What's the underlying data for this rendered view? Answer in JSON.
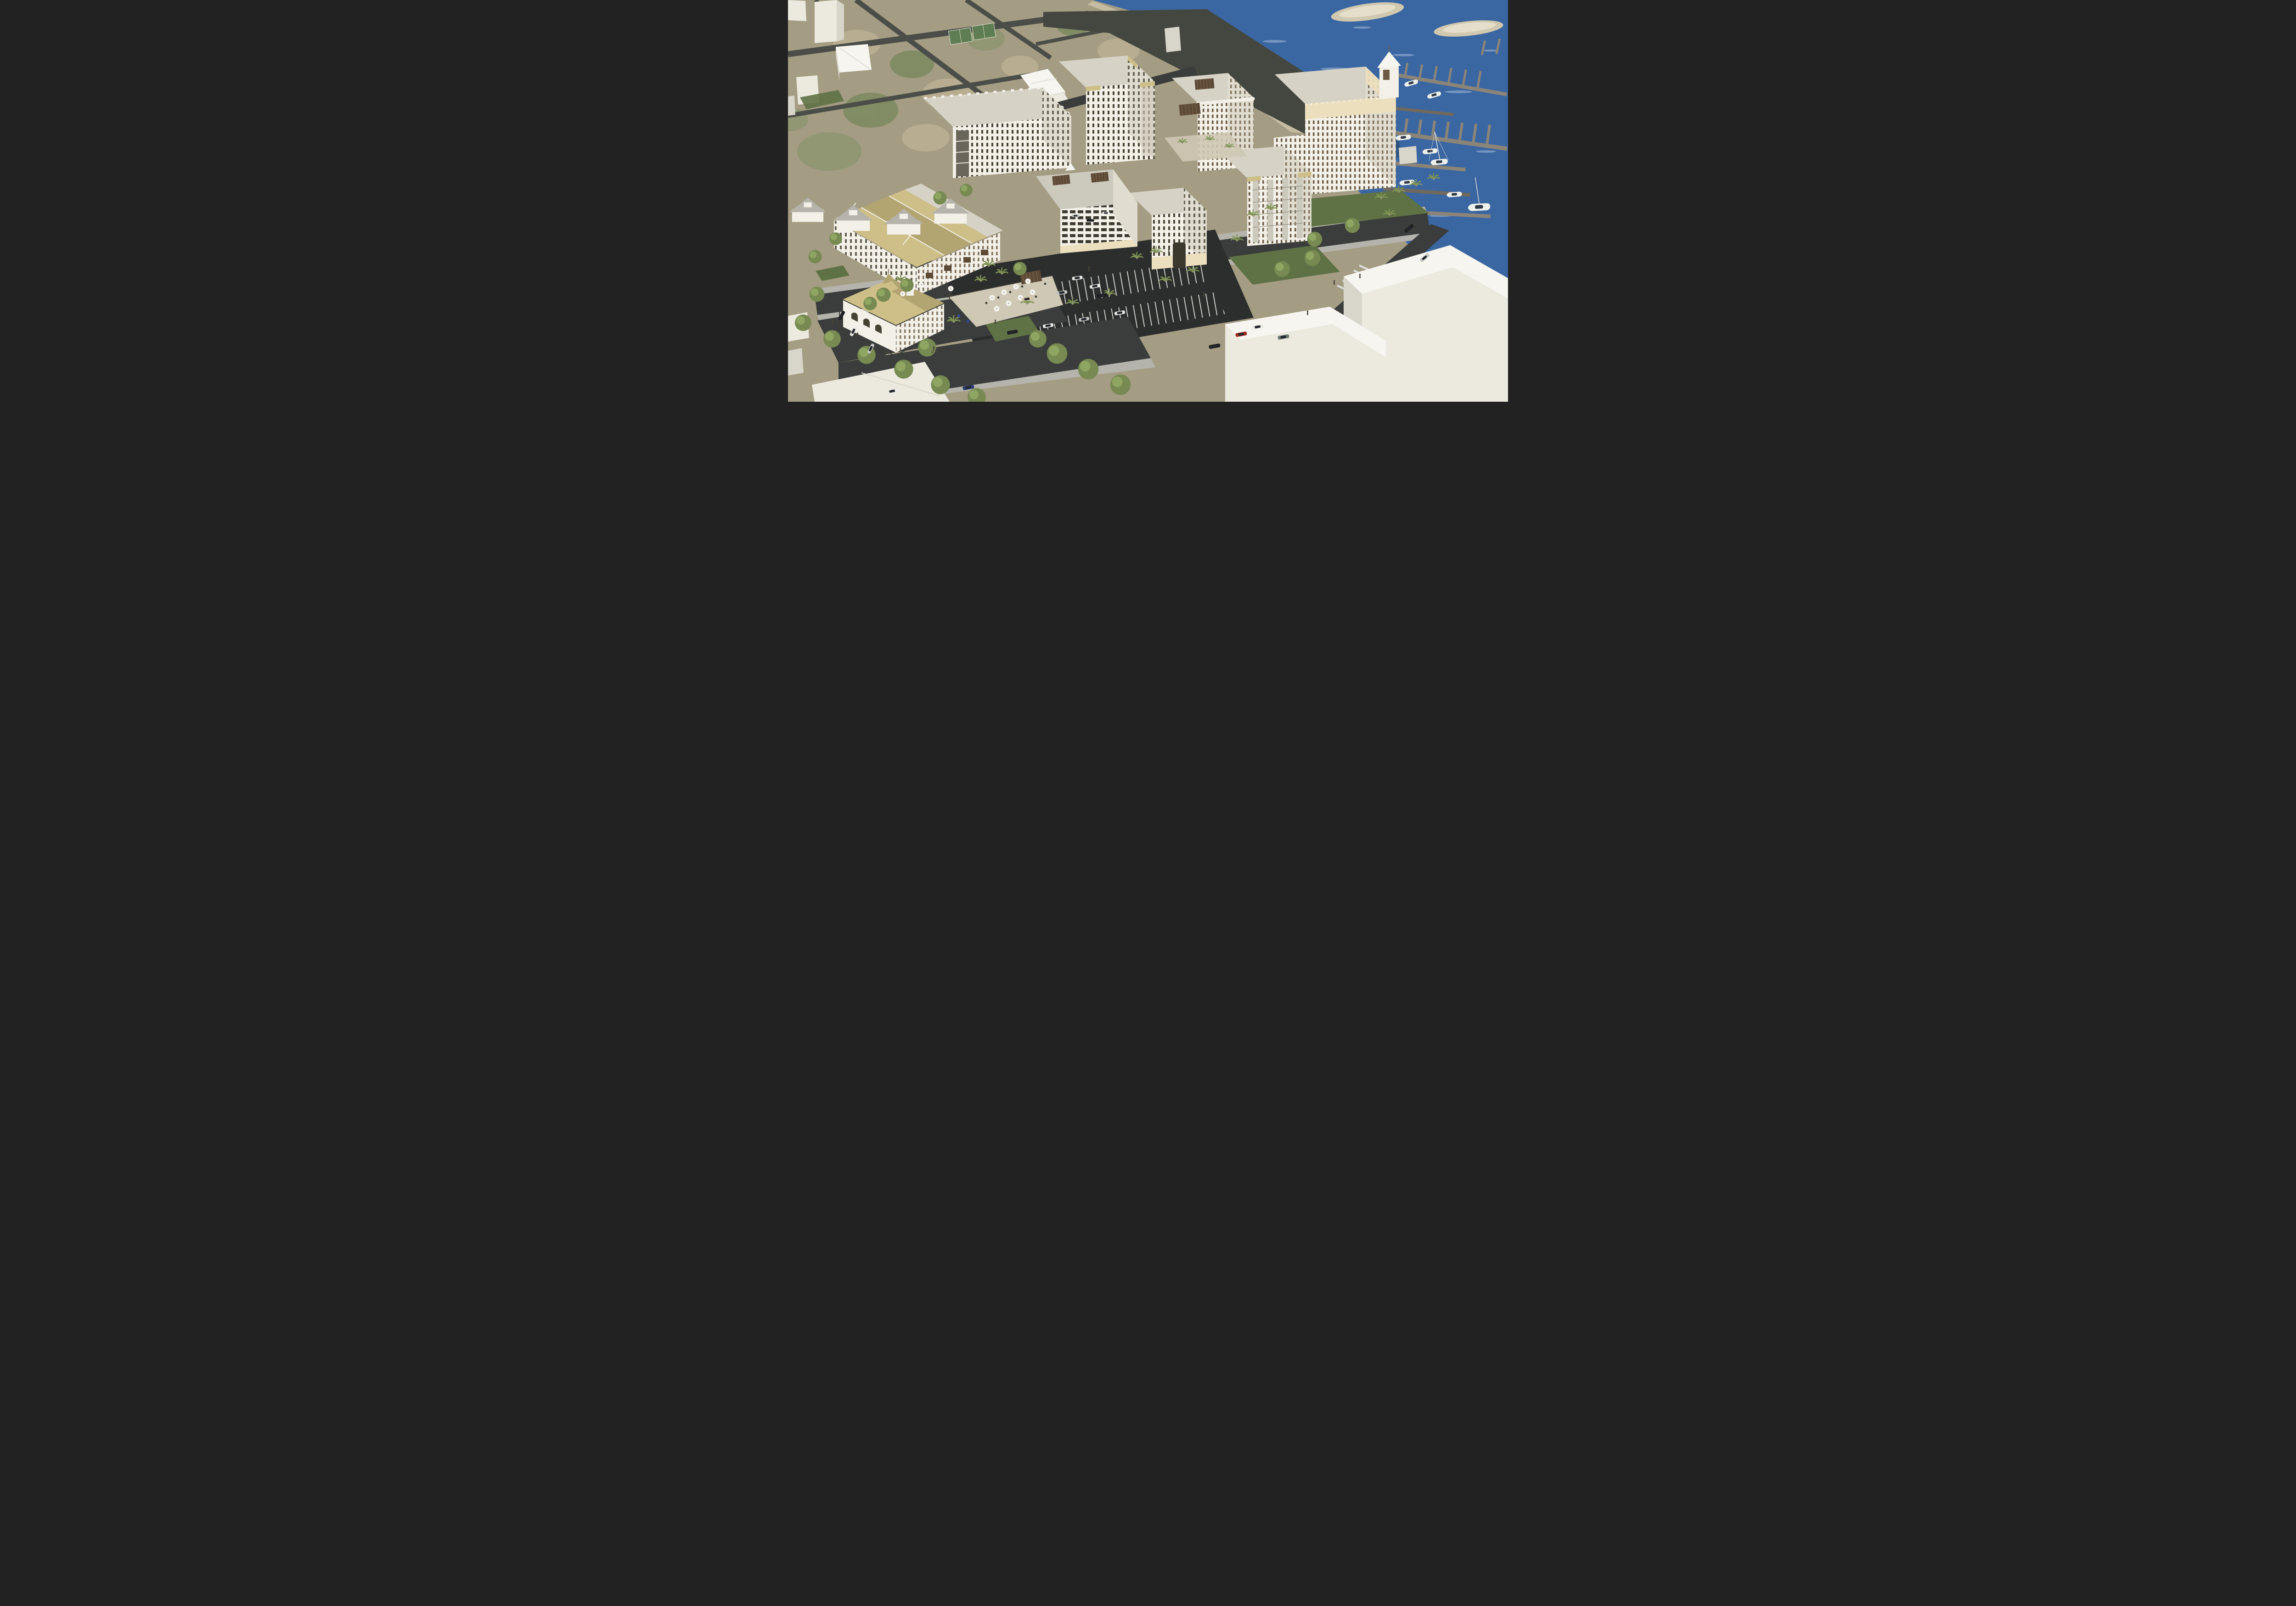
{
  "image": {
    "kind": "3D architectural rendering",
    "view": "aerial oblique, looking north-east over a coastal mixed-use development and marina",
    "lighting": "low warm sun from the west, long shadows",
    "text_visible": "none"
  },
  "palette": {
    "land_photo": "#a49c83",
    "land_green": "#7c8a60",
    "land_green2": "#8e9671",
    "land_tan": "#bcb094",
    "beach": "#c9c0a5",
    "context_road": "#4b4e48",
    "plaza_dark": "#44473f",
    "water": "#3a66a2",
    "water_deep": "#2c4d78",
    "water_sparkle": "#cfdcea",
    "island_sand": "#d0c8af",
    "island_core": "#e4decb",
    "dock": "#8b8478",
    "dock_dark": "#6f695e",
    "boat_white": "#eef0ec",
    "boat_glass": "#2e3744",
    "boat_dark_hull": "#4a2e1e",
    "mast": "#e8e8e4",
    "asphalt": "#3a3d3b",
    "asphalt_shadow": "#2b2e2c",
    "sidewalk": "#b5b4ac",
    "paver": "#cfc8b4",
    "stripe": "#dededa",
    "grass": "#5f7245",
    "tree": "#768a52",
    "tree_light": "#9db36c",
    "palm": "#7e9454",
    "palm_trunk": "#9a8f77",
    "building_white": "#f3f0e8",
    "building_shade": "#e0dccf",
    "building_deep_shade": "#cfc9bb",
    "massing_white": "#eceade",
    "massing_top": "#f6f5f0",
    "massing_side": "#d8d5ca",
    "roof_flat": "#d6d2c6",
    "roof_deck": "#ccc9bd",
    "roof_gray": "#b5b3aa",
    "roof_straw": "#cdbf87",
    "roof_straw_dark": "#b3a571",
    "cream_band": "#ecdfbd",
    "window_dark": "#474334",
    "window_brown": "#6a5a44",
    "garage_opening": "#3b382e",
    "open_corridor": "#6b665a",
    "pergola": "#5c4936",
    "pergola_slat": "#7a6348",
    "iron_rail": "#3c3c38",
    "umbrella": "#f4f3ee",
    "umbrella_pole": "#8d8a80",
    "car_glass": "#23262c",
    "car_white": "#e9e9e6",
    "car_silver": "#c0c2bf",
    "car_black": "#1e2022",
    "car_red": "#9e2b23",
    "car_dark_red": "#7c1f1e",
    "car_blue": "#2b3a74",
    "car_tan": "#cfc5a6",
    "car_gray": "#6d7a72",
    "person": "#4a443c",
    "court_green": "#5f7d52"
  },
  "scene": {
    "water": {
      "islands": 2,
      "marina": {
        "pier_groups": 3,
        "boats": 9,
        "boat_types": [
          "white motorboats",
          "white sailboat with mast and rigging",
          "dark-hull sailboat",
          "white catamaran"
        ]
      }
    },
    "context": {
      "ground": "faded olive and tan aerial orthophoto",
      "massing_buildings": "untextured white block models",
      "features": [
        "diagonal street grid",
        "2 tennis courts on peninsula",
        "beach strip",
        "row of gray hip-roof houses",
        "large dark paved boatyard plaza"
      ]
    },
    "development": {
      "buildings": [
        {
          "id": "left-apartment-building",
          "stories": 6,
          "roof": "flat gray roof with crenellated parapet",
          "facade": "white stucco, dark multi-pane windows, open corner breezeway"
        },
        {
          "id": "north-tower",
          "stories": 9,
          "roof": "flat roof with straw corner awnings",
          "facade": "white, iron balconies, balcony bay on harbor side"
        },
        {
          "id": "scalloped-parapet-building",
          "stories": 7,
          "roof": "mission scalloped parapet with rooftop pergola",
          "facade": "white, brown french doors, juliet balconies"
        },
        {
          "id": "harbor-hotel-tower",
          "stories": 11,
          "roof": "cream ornamental crown, finials, pyramidal corner turret",
          "facade": "white, brown windows, iron juliet balconies"
        },
        {
          "id": "balcony-midrise",
          "stories": 8,
          "roof": "flat with straw corner awnings",
          "facade": "white with stacked gray balcony strips"
        },
        {
          "id": "central-midrise",
          "stories": 5,
          "roof": "flat",
          "facade": "white over tan retail base with central archway"
        },
        {
          "id": "parking-garage",
          "stories": 4,
          "roof": "amenity deck, twin pergolas, white pavilion",
          "facade": "open bays with parked cars",
          "cars_inside": 3
        },
        {
          "id": "townhome-row",
          "stories": 3,
          "roof": "straw shingle gables",
          "facade": "white, brown wood balconies, sidewalk cafe umbrellas"
        },
        {
          "id": "restaurant-villa",
          "stories": 2,
          "roof": "straw hip roof with turret and dormer",
          "facade": "white arched veranda, fenced dining patio with umbrellas and pergola"
        }
      ],
      "courtyard": "paver terraces with potted palms and iron railings",
      "pergolas": 5
    },
    "streetscape": {
      "street_vehicles": 20,
      "vehicle_colors": [
        "white",
        "silver",
        "black",
        "red",
        "dark-red",
        "blue",
        "tan",
        "gray"
      ],
      "parking": "angled surface stalls with white striping; parallel street parking",
      "crosswalk": true,
      "pedestrians": 10,
      "cyclist": 1
    },
    "vegetation": {
      "palms": 20,
      "shade_trees": 24,
      "lawns": "green verges along the main street and waterfront",
      "umbrellas": 12
    }
  }
}
